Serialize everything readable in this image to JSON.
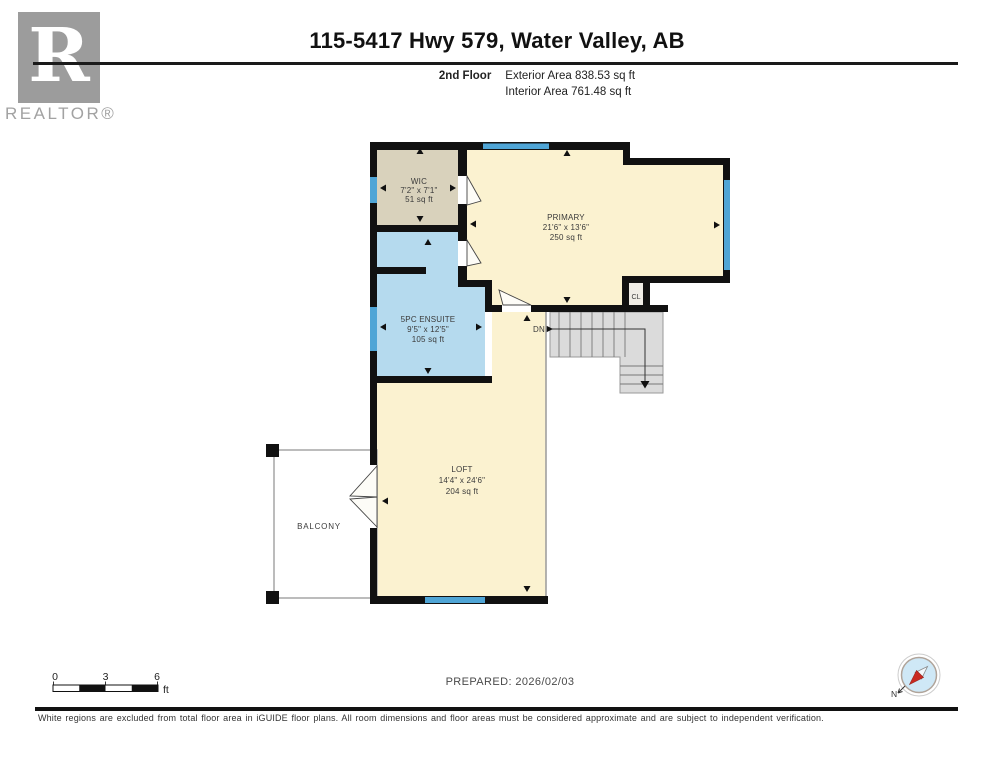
{
  "header": {
    "title": "115-5417 Hwy 579, Water Valley, AB",
    "floor_label": "2nd Floor",
    "exterior_area": "Exterior Area 838.53 sq ft",
    "interior_area": "Interior Area 761.48 sq ft"
  },
  "logo": {
    "letter": "R",
    "realtor_text": "REALTOR®"
  },
  "rooms": [
    {
      "name": "WIC",
      "dims": "7'2\" x 7'1\"",
      "area": "51 sq ft"
    },
    {
      "name": "PRIMARY",
      "dims": "21'6\" x 13'6\"",
      "area": "250 sq ft"
    },
    {
      "name": "5PC ENSUITE",
      "dims": "9'5\" x 12'5\"",
      "area": "105 sq ft"
    },
    {
      "name": "LOFT",
      "dims": "14'4\" x 24'6\"",
      "area": "204 sq ft"
    },
    {
      "name": "BALCONY"
    },
    {
      "name": "CL"
    }
  ],
  "stairs": {
    "down_label": "DN"
  },
  "scale_bar": {
    "ticks": [
      "0",
      "3",
      "6"
    ],
    "unit": "ft"
  },
  "compass": {
    "north_label": "N"
  },
  "footer": {
    "prepared": "PREPARED: 2026/02/03",
    "disclaimer": "White regions are excluded from total floor area in iGUIDE floor plans. All room dimensions and floor areas must be considered approximate and are subject to independent verification."
  },
  "colors": {
    "wall": "#111111",
    "window": "#4fa5d6",
    "room_cream": "#fbf2d0",
    "room_tan": "#d9d2bc",
    "room_blue": "#b5daee",
    "stairs_gray": "#dbdbdb",
    "logo_gray": "#9c9c9c",
    "compass_red": "#c92a21",
    "compass_blue": "#cfe8f6"
  }
}
